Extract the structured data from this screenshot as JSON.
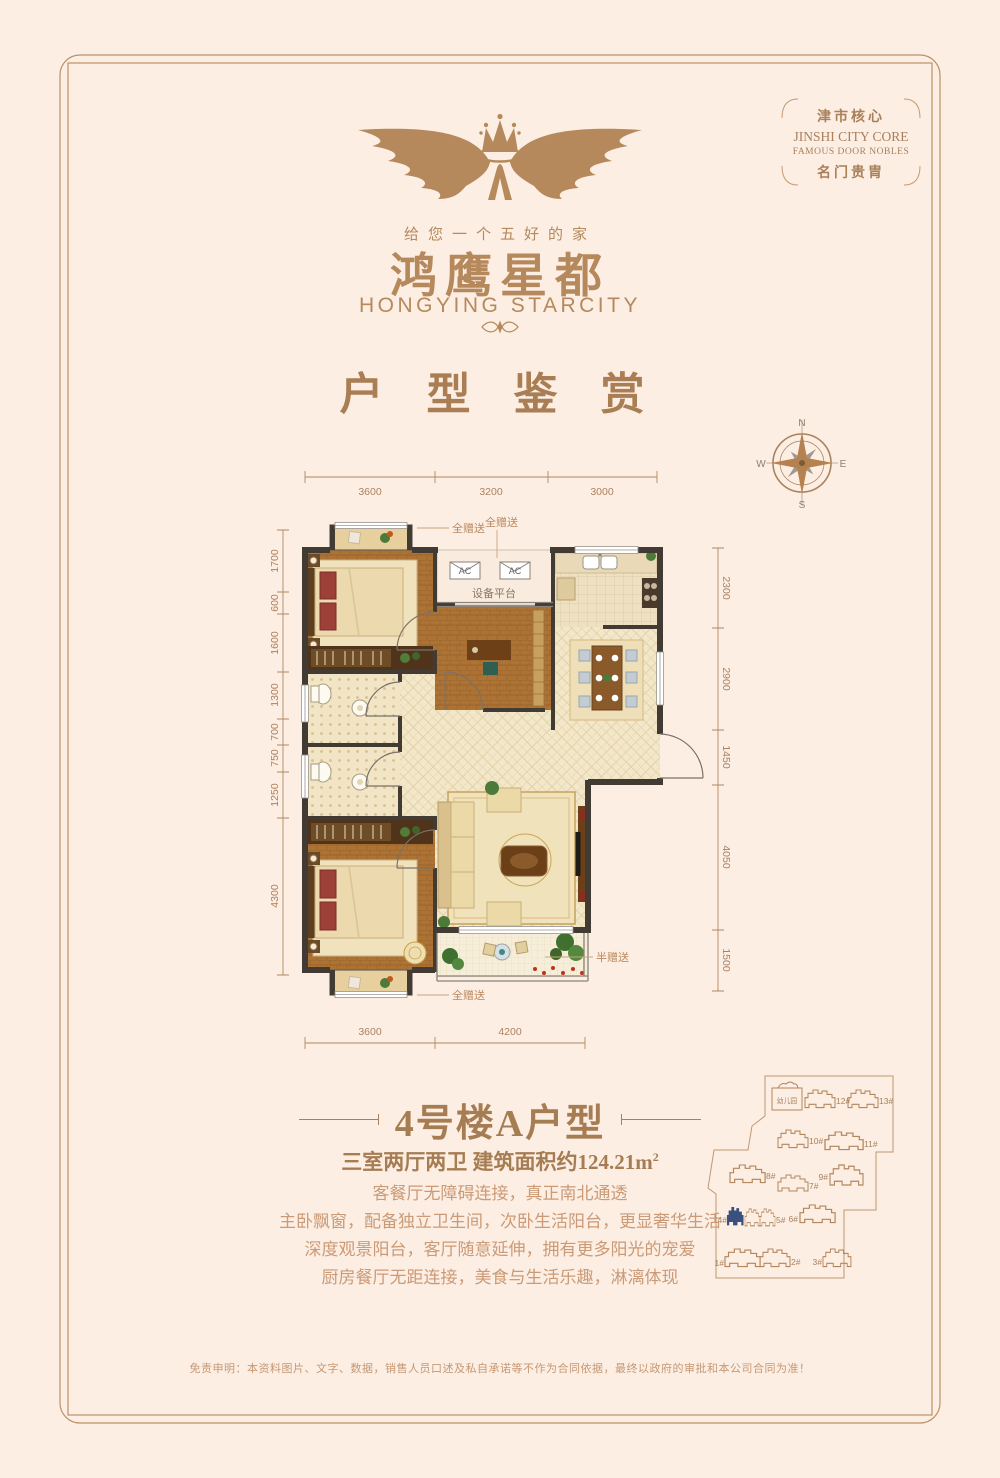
{
  "badge": {
    "line1": "津市核心",
    "line2": "JINSHI CITY CORE",
    "line3": "FAMOUS DOOR NOBLES",
    "line4": "名门贵胄"
  },
  "logo": {
    "tagline": "给您一个五好的家",
    "brand_cn": "鸿鹰星都",
    "brand_en": "HONGYING STARCITY",
    "mark_icon": "winged-crown"
  },
  "section_title": "户 型 鉴 赏",
  "compass": {
    "n": "N",
    "e": "E",
    "s": "S",
    "w": "W"
  },
  "floorplan": {
    "dims_top": [
      "3600",
      "3200",
      "3000"
    ],
    "dims_bottom": [
      "3600",
      "4200"
    ],
    "dims_left": [
      "1700",
      "600",
      "1600",
      "1300",
      "700",
      "750",
      "1250",
      "4300"
    ],
    "dims_right": [
      "2300",
      "2900",
      "1450",
      "4050",
      "1500"
    ],
    "labels": {
      "gift_full": "全赠送",
      "gift_half": "半赠送",
      "platform": "设备平台",
      "ac": "AC"
    }
  },
  "unit": {
    "title": "4号楼A户型",
    "spec": "三室两厅两卫 建筑面积约124.21m",
    "spec_sup": "2",
    "desc": [
      "客餐厅无障碍连接，真正南北通透",
      "主卧飘窗，配备独立卫生间，次卧生活阳台，更显奢华生活",
      "深度观景阳台，客厅随意延伸，拥有更多阳光的宠爱",
      "厨房餐厅无距连接，美食与生活乐趣，淋漓体现"
    ]
  },
  "sitemap": {
    "kindergarten": "幼儿园",
    "highlighted_building": "4#",
    "highlight_color": "#3a5180",
    "labels": {
      "b1": "1#",
      "b2": "2#",
      "b3": "3#",
      "b4": "4#",
      "b5": "5#",
      "b6": "6#",
      "b7": "7#",
      "b8": "8#",
      "b9": "9#",
      "b10": "10#",
      "b11": "11#",
      "b12": "12#",
      "b13": "13#"
    }
  },
  "disclaimer": "免责申明：本资料图片、文字、数据，销售人员口述及私自承诺等不作为合同依据，最终以政府的审批和本公司合同为准！",
  "colors": {
    "background": "#fceee3",
    "brand": "#b5895c",
    "heading": "#a67c52",
    "body_text": "#cb9a76",
    "dimension": "#ad8160",
    "wall": "#423b33",
    "highlight": "#3a5180"
  }
}
